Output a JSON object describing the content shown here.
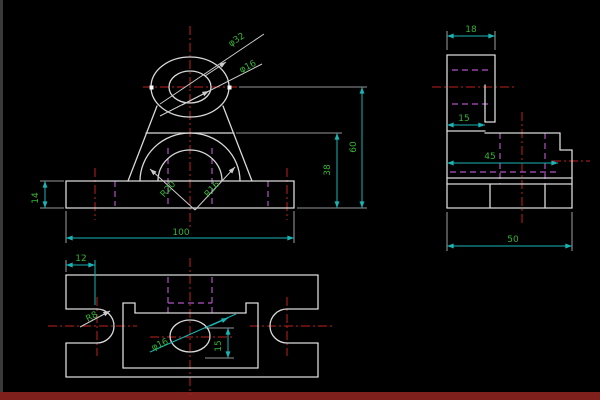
{
  "canvas": {
    "background": "#000000",
    "left_strip_color": "#3a3a3a",
    "bottom_strip_color": "#80201d"
  },
  "colors": {
    "outline": "#d9d9d9",
    "dimension_line": "#1ab4b4",
    "dimension_text": "#35b335",
    "centerline": "#c22020",
    "hidden_line": "#b052c2"
  },
  "front_view": {
    "labels": {
      "boss_outer_dia": "φ32",
      "boss_hole_dia": "φ16",
      "base_height": "14",
      "base_width": "100",
      "arch_outer_radius": "R20",
      "arch_inner_radius": "R16",
      "arch_top_height": "38",
      "hole_center_height": "60"
    }
  },
  "side_view": {
    "labels": {
      "ear_thickness": "18",
      "step_width": "15",
      "mid_depth": "45",
      "base_depth": "50"
    }
  },
  "plan_view": {
    "labels": {
      "slot_center_offset": "12",
      "slot_radius": "R8",
      "hole_dia": "φ16",
      "hole_offset": "15"
    }
  }
}
